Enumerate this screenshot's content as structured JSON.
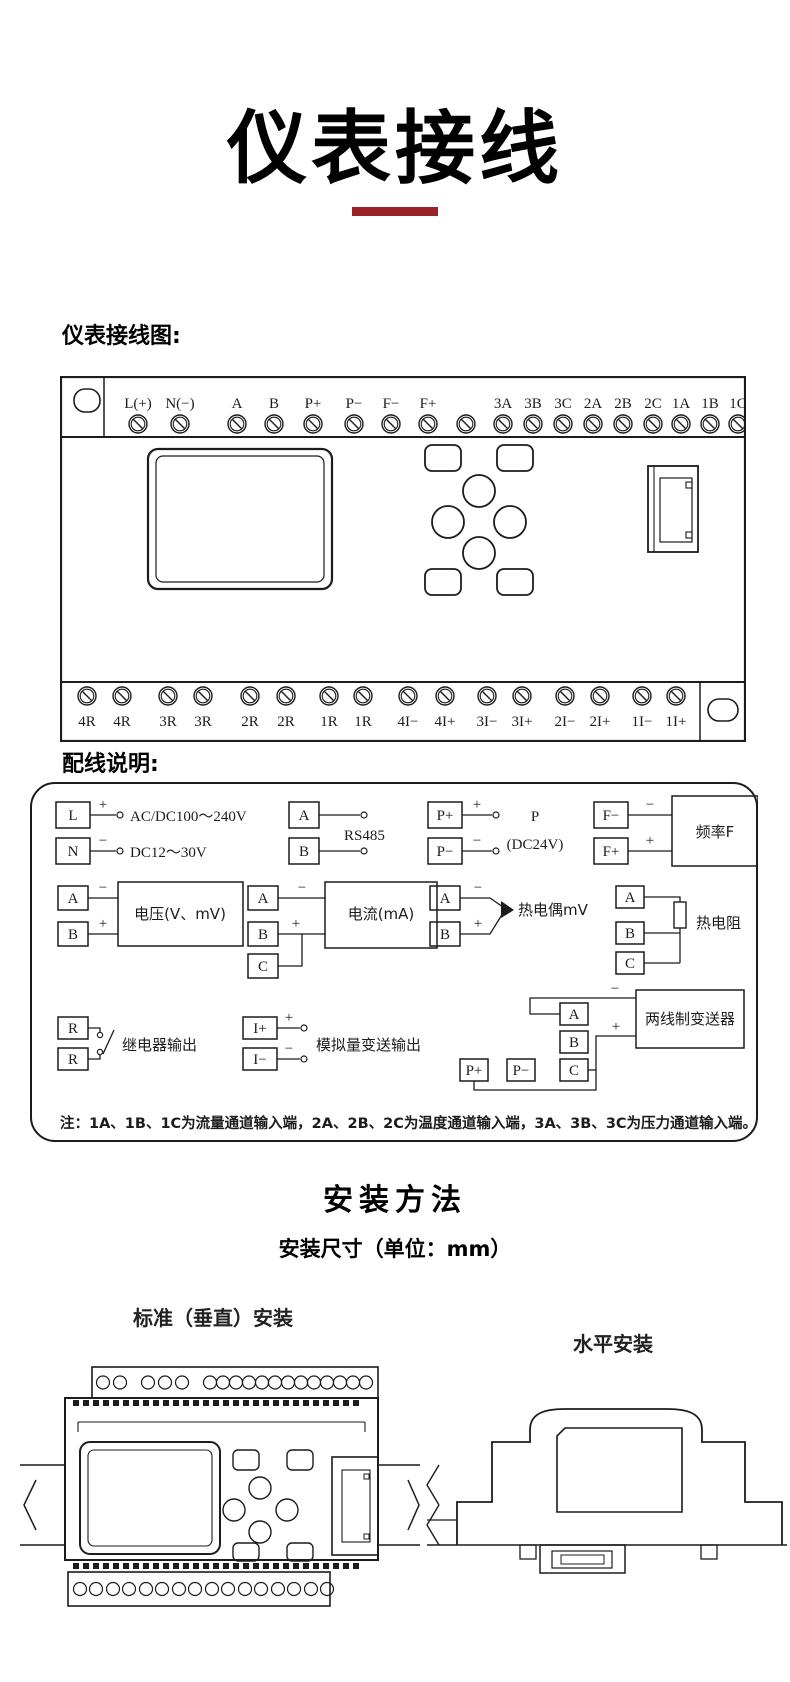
{
  "page": {
    "title": "仪表接线",
    "accent_color": "#9b2328"
  },
  "figure1": {
    "label": "仪表接线图:",
    "top_terminals": [
      "L(+)",
      "N(−)",
      "A",
      "B",
      "P+",
      "P−",
      "F−",
      "F+",
      "3A",
      "3B",
      "3C",
      "2A",
      "2B",
      "2C",
      "1A",
      "1B",
      "1C"
    ],
    "bottom_terminals": [
      "4R",
      "4R",
      "3R",
      "3R",
      "2R",
      "2R",
      "1R",
      "1R",
      "4I−",
      "4I+",
      "3I−",
      "3I+",
      "2I−",
      "2I+",
      "1I−",
      "1I+"
    ]
  },
  "wiring": {
    "label": "配线说明:",
    "power": {
      "t1": "L",
      "t2": "N",
      "s1": "+",
      "s2": "−",
      "line1": "AC/DC100～240V",
      "line2": "DC12～30V"
    },
    "rs485": {
      "t1": "A",
      "t2": "B",
      "label": "RS485"
    },
    "p24": {
      "t1": "P+",
      "t2": "P−",
      "s1": "+",
      "s2": "−",
      "line1": "P",
      "line2": "(DC24V)"
    },
    "freq": {
      "t1": "F−",
      "t2": "F+",
      "s1": "−",
      "s2": "+",
      "label": "频率F"
    },
    "voltage": {
      "t1": "A",
      "t2": "B",
      "s1": "−",
      "s2": "+",
      "label": "电压(V、mV)"
    },
    "current": {
      "t1": "A",
      "t2": "B",
      "t3": "C",
      "s1": "−",
      "s2": "+",
      "label": "电流(mA)"
    },
    "thermocouple": {
      "t1": "A",
      "t2": "B",
      "s1": "−",
      "s2": "+",
      "label": "热电偶mV"
    },
    "rtd": {
      "t1": "A",
      "t2": "B",
      "t3": "C",
      "label": "热电阻"
    },
    "relay": {
      "t1": "R",
      "t2": "R",
      "label": "继电器输出"
    },
    "analog_out": {
      "t1": "I+",
      "t2": "I−",
      "s1": "+",
      "s2": "−",
      "label": "模拟量变送输出"
    },
    "transmitter": {
      "t1": "A",
      "t2": "B",
      "t3": "C",
      "t4": "P+",
      "t5": "P−",
      "s1": "−",
      "s2": "+",
      "label": "两线制变送器"
    },
    "note": "注：1A、1B、1C为流量通道输入端，2A、2B、2C为温度通道输入端，3A、3B、3C为压力通道输入端。"
  },
  "installation": {
    "heading": "安装方法",
    "subheading": "安装尺寸（单位：mm）",
    "vertical_label": "标准（垂直）安装",
    "horizontal_label": "水平安装"
  }
}
